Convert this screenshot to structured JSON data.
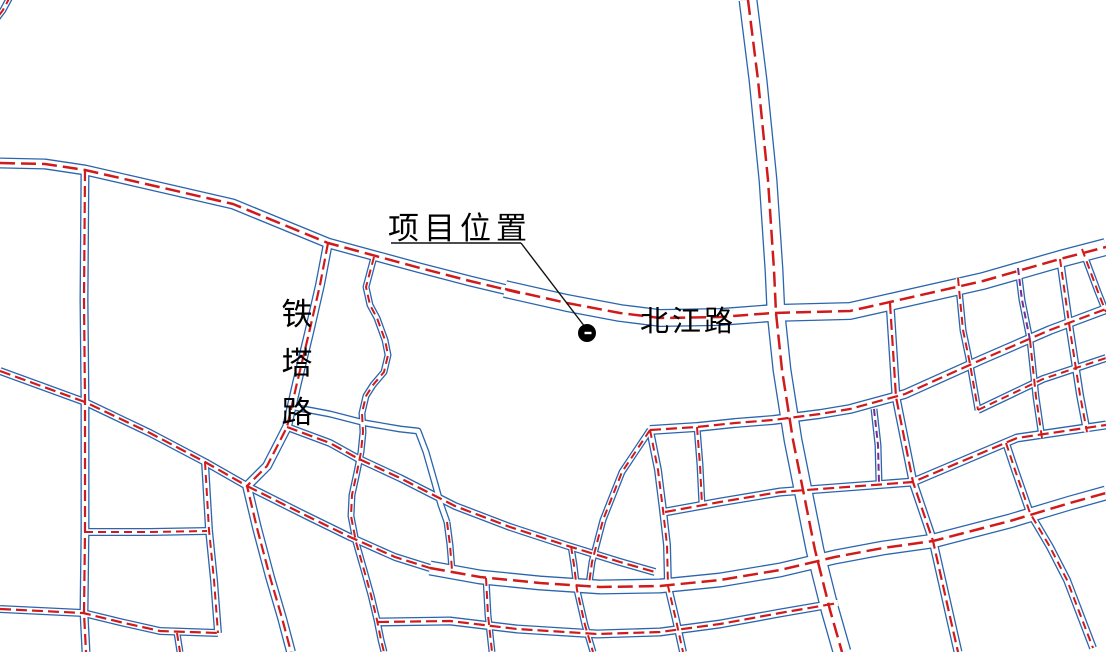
{
  "title": "项目区位图",
  "labels": {
    "project_location": "项目位置",
    "beijiang_road": "北江路",
    "tieta_road": "铁塔路",
    "tieta_chars": [
      "铁",
      "塔",
      "路"
    ]
  },
  "colors": {
    "road_edge": "#2a65ad",
    "centerline": "#cf1b1b",
    "overlap": "#7b2b8d",
    "annotation": "#111111",
    "marker": "#000000",
    "background": "#ffffff"
  },
  "marker": {
    "x": 587,
    "y": 333,
    "r": 9,
    "tick_w": 7,
    "tick_h": 2.4
  },
  "annotation": {
    "underline": [
      [
        391,
        243
      ],
      [
        521,
        243
      ]
    ],
    "leader": [
      [
        521,
        243
      ],
      [
        585,
        327
      ]
    ]
  },
  "map": {
    "width": 1106,
    "height": 652,
    "roads": [
      {
        "id": "beijiang-west",
        "name": "北江路",
        "w": 11,
        "line": "red",
        "cls": "major",
        "pts": [
          [
            0,
            163
          ],
          [
            45,
            164
          ],
          [
            85,
            170
          ],
          [
            133,
            181
          ],
          [
            233,
            204
          ],
          [
            328,
            243
          ],
          [
            420,
            268
          ],
          [
            470,
            281
          ],
          [
            520,
            293
          ]
        ]
      },
      {
        "id": "beijiang-east",
        "name": "北江路",
        "w": 18,
        "line": "red",
        "cls": "major",
        "pts": [
          [
            505,
            289
          ],
          [
            567,
            303
          ],
          [
            620,
            313
          ],
          [
            660,
            318
          ],
          [
            720,
            317
          ],
          [
            773,
            313
          ],
          [
            850,
            311
          ],
          [
            890,
            302
          ],
          [
            983,
            281
          ],
          [
            1060,
            259
          ],
          [
            1106,
            247
          ]
        ]
      },
      {
        "id": "north-vertical",
        "w": 19,
        "line": "red",
        "cls": "major",
        "pts": [
          [
            748,
            0
          ],
          [
            758,
            80
          ],
          [
            768,
            180
          ],
          [
            774,
            270
          ],
          [
            776,
            313
          ],
          [
            782,
            370
          ],
          [
            793,
            440
          ],
          [
            803,
            490
          ],
          [
            815,
            550
          ],
          [
            830,
            610
          ],
          [
            842,
            652
          ]
        ]
      },
      {
        "id": "south-main",
        "w": 15,
        "line": "red",
        "cls": "major",
        "pts": [
          [
            430,
            568
          ],
          [
            480,
            577
          ],
          [
            540,
            583
          ],
          [
            600,
            587
          ],
          [
            660,
            586
          ],
          [
            720,
            580
          ],
          [
            780,
            570
          ],
          [
            835,
            557
          ],
          [
            883,
            548
          ],
          [
            933,
            541
          ],
          [
            1010,
            521
          ],
          [
            1070,
            503
          ],
          [
            1106,
            493
          ]
        ]
      },
      {
        "id": "west-vertical",
        "w": 9,
        "line": "red",
        "cls": "sec",
        "pts": [
          [
            85,
            170
          ],
          [
            84,
            300
          ],
          [
            85,
            402
          ],
          [
            85,
            532
          ],
          [
            84,
            613
          ],
          [
            86,
            652
          ]
        ]
      },
      {
        "id": "tieta-road",
        "name": "铁塔路",
        "w": 10,
        "line": "red",
        "cls": "sec",
        "pts": [
          [
            328,
            243
          ],
          [
            320,
            285
          ],
          [
            309,
            333
          ],
          [
            297,
            383
          ],
          [
            287,
            427
          ],
          [
            267,
            466
          ],
          [
            247,
            486
          ],
          [
            257,
            528
          ],
          [
            270,
            577
          ],
          [
            282,
            618
          ],
          [
            291,
            652
          ]
        ]
      },
      {
        "id": "west-diagonal",
        "w": 8,
        "line": "red",
        "cls": "sec",
        "pts": [
          [
            0,
            371
          ],
          [
            85,
            402
          ],
          [
            150,
            433
          ],
          [
            205,
            462
          ],
          [
            247,
            486
          ]
        ]
      },
      {
        "id": "diag-to-south",
        "w": 8,
        "line": "red",
        "cls": "sec",
        "pts": [
          [
            247,
            486
          ],
          [
            305,
            515
          ],
          [
            350,
            537
          ],
          [
            395,
            557
          ],
          [
            430,
            568
          ]
        ]
      },
      {
        "id": "mid-diagonal",
        "w": 8,
        "line": "red",
        "cls": "sec",
        "pts": [
          [
            287,
            427
          ],
          [
            330,
            443
          ],
          [
            357,
            458
          ],
          [
            400,
            478
          ],
          [
            455,
            506
          ],
          [
            510,
            527
          ],
          [
            565,
            545
          ],
          [
            620,
            562
          ],
          [
            655,
            572
          ]
        ]
      },
      {
        "id": "east-upper",
        "w": 10,
        "line": "red",
        "cls": "sec",
        "pts": [
          [
            650,
            430
          ],
          [
            697,
            427
          ],
          [
            735,
            423
          ],
          [
            773,
            420
          ],
          [
            820,
            414
          ],
          [
            850,
            409
          ],
          [
            905,
            394
          ],
          [
            983,
            359
          ],
          [
            1050,
            330
          ],
          [
            1106,
            309
          ]
        ]
      },
      {
        "id": "east-mid",
        "w": 9,
        "line": "red",
        "cls": "sec",
        "pts": [
          [
            665,
            512
          ],
          [
            720,
            502
          ],
          [
            780,
            492
          ],
          [
            860,
            486
          ],
          [
            913,
            482
          ],
          [
            1017,
            438
          ],
          [
            1106,
            425
          ]
        ]
      },
      {
        "id": "east-short-rise",
        "w": 8,
        "line": "red",
        "cls": "min",
        "pts": [
          [
            978,
            410
          ],
          [
            1043,
            379
          ],
          [
            1106,
            358
          ]
        ]
      },
      {
        "id": "ne-fall-1",
        "w": 9,
        "line": "red",
        "cls": "sec",
        "pts": [
          [
            890,
            303
          ],
          [
            896,
            397
          ],
          [
            913,
            482
          ],
          [
            933,
            541
          ],
          [
            953,
            630
          ],
          [
            958,
            652
          ]
        ]
      },
      {
        "id": "ne-fall-2",
        "w": 7,
        "line": "red",
        "cls": "min",
        "pts": [
          [
            958,
            278
          ],
          [
            963,
            330
          ],
          [
            970,
            364
          ],
          [
            978,
            410
          ]
        ]
      },
      {
        "id": "ne-purple",
        "w": 7,
        "line": "purple",
        "cls": "min",
        "pts": [
          [
            1018,
            268
          ],
          [
            1022,
            300
          ],
          [
            1030,
            340
          ]
        ]
      },
      {
        "id": "ne-purple-south",
        "w": 7,
        "line": "red",
        "cls": "min",
        "pts": [
          [
            1030,
            340
          ],
          [
            1036,
            397
          ],
          [
            1042,
            438
          ]
        ]
      },
      {
        "id": "ne-fall-3",
        "w": 8,
        "line": "red",
        "cls": "min",
        "pts": [
          [
            1060,
            259
          ],
          [
            1070,
            330
          ],
          [
            1080,
            395
          ],
          [
            1087,
            432
          ]
        ]
      },
      {
        "id": "edge-stub",
        "w": 7,
        "line": "red",
        "cls": "min",
        "pts": [
          [
            1082,
            249
          ],
          [
            1098,
            292
          ],
          [
            1106,
            312
          ]
        ]
      },
      {
        "id": "purple-vert",
        "w": 7,
        "line": "purple",
        "cls": "min",
        "pts": [
          [
            874,
            409
          ],
          [
            878,
            445
          ],
          [
            879,
            483
          ]
        ]
      },
      {
        "id": "se-fall",
        "w": 8,
        "line": "red",
        "cls": "min",
        "pts": [
          [
            1006,
            443
          ],
          [
            1015,
            470
          ],
          [
            1030,
            513
          ],
          [
            1050,
            547
          ],
          [
            1067,
            580
          ],
          [
            1093,
            648
          ]
        ]
      },
      {
        "id": "mid-vert-1",
        "w": 8,
        "line": "red",
        "cls": "min",
        "pts": [
          [
            650,
            430
          ],
          [
            658,
            470
          ],
          [
            663,
            510
          ],
          [
            667,
            545
          ],
          [
            668,
            586
          ],
          [
            676,
            620
          ],
          [
            683,
            652
          ]
        ]
      },
      {
        "id": "mid-vert-2",
        "w": 7,
        "line": "red",
        "cls": "min",
        "pts": [
          [
            697,
            427
          ],
          [
            700,
            465
          ],
          [
            702,
            505
          ]
        ]
      },
      {
        "id": "mid-branch",
        "w": 7,
        "line": "red",
        "cls": "min",
        "pts": [
          [
            650,
            430
          ],
          [
            622,
            472
          ],
          [
            603,
            520
          ],
          [
            592,
            562
          ],
          [
            589,
            584
          ]
        ]
      },
      {
        "id": "south-lower",
        "w": 9,
        "line": "red",
        "cls": "sec",
        "pts": [
          [
            378,
            622
          ],
          [
            450,
            621
          ],
          [
            517,
            629
          ],
          [
            597,
            634
          ],
          [
            660,
            632
          ],
          [
            720,
            624
          ],
          [
            780,
            613
          ],
          [
            838,
            603
          ]
        ]
      },
      {
        "id": "southwest-road",
        "w": 8,
        "line": "red",
        "cls": "sec",
        "pts": [
          [
            0,
            609
          ],
          [
            83,
            613
          ],
          [
            120,
            622
          ],
          [
            160,
            631
          ],
          [
            218,
            633
          ]
        ]
      },
      {
        "id": "west-link",
        "w": 8,
        "line": "red",
        "cls": "min",
        "pts": [
          [
            85,
            532
          ],
          [
            150,
            532
          ],
          [
            207,
            531
          ]
        ]
      },
      {
        "id": "west-vert-2",
        "w": 8,
        "line": "red",
        "cls": "min",
        "pts": [
          [
            205,
            462
          ],
          [
            209,
            530
          ],
          [
            214,
            580
          ],
          [
            218,
            633
          ]
        ]
      },
      {
        "id": "stub-south",
        "w": 7,
        "line": "red",
        "cls": "min",
        "pts": [
          [
            177,
            633
          ],
          [
            180,
            652
          ]
        ]
      },
      {
        "id": "curvy-road",
        "w": 7,
        "line": "red",
        "cls": "min",
        "pts": [
          [
            374,
            257
          ],
          [
            366,
            287
          ],
          [
            370,
            305
          ],
          [
            377,
            318
          ],
          [
            385,
            340
          ],
          [
            388,
            355
          ],
          [
            384,
            372
          ],
          [
            373,
            385
          ],
          [
            366,
            396
          ],
          [
            362,
            413
          ],
          [
            363,
            432
          ],
          [
            361,
            452
          ],
          [
            357,
            472
          ],
          [
            352,
            495
          ],
          [
            351,
            516
          ],
          [
            356,
            542
          ],
          [
            364,
            570
          ],
          [
            371,
            595
          ],
          [
            377,
            620
          ],
          [
            381,
            640
          ],
          [
            384,
            652
          ]
        ]
      },
      {
        "id": "block-edge-blue",
        "w": 7,
        "line": "none",
        "cls": "min",
        "pts": [
          [
            293,
            407
          ],
          [
            330,
            414
          ],
          [
            365,
            423
          ],
          [
            400,
            429
          ],
          [
            418,
            431
          ],
          [
            426,
            452
          ],
          [
            434,
            480
          ],
          [
            441,
            505
          ],
          [
            447,
            522
          ]
        ]
      },
      {
        "id": "block-stub",
        "w": 7,
        "line": "red",
        "cls": "min",
        "pts": [
          [
            447,
            522
          ],
          [
            450,
            545
          ],
          [
            452,
            570
          ]
        ]
      },
      {
        "id": "south-vert-1",
        "w": 7,
        "line": "red",
        "cls": "min",
        "pts": [
          [
            571,
            546
          ],
          [
            574,
            565
          ],
          [
            577,
            590
          ],
          [
            585,
            625
          ],
          [
            593,
            652
          ]
        ]
      },
      {
        "id": "south-vert-2",
        "w": 7,
        "line": "red",
        "cls": "min",
        "pts": [
          [
            486,
            578
          ],
          [
            488,
            615
          ],
          [
            492,
            652
          ]
        ]
      },
      {
        "id": "corner-stub",
        "w": 7,
        "line": "red",
        "cls": "min",
        "pts": [
          [
            10,
            -3
          ],
          [
            3,
            10
          ],
          [
            -3,
            18
          ]
        ]
      }
    ]
  }
}
